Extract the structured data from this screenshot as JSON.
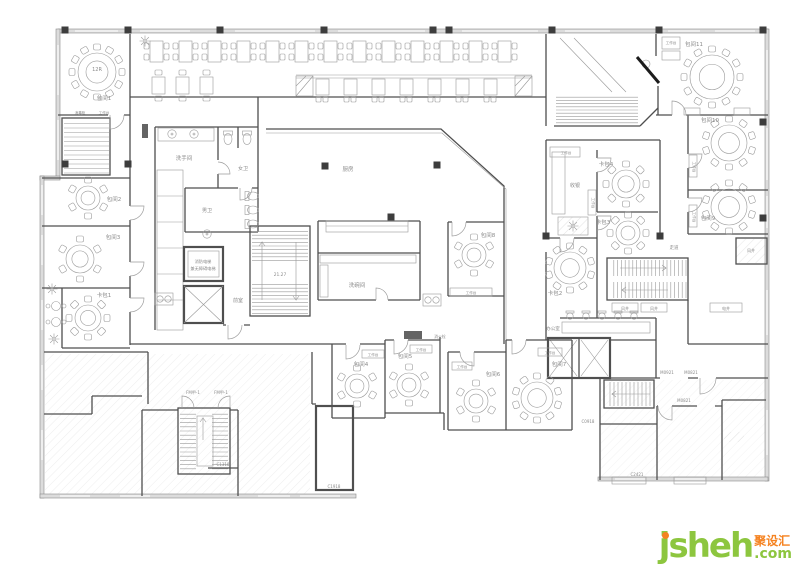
{
  "watermark": {
    "brand": "jsheh",
    "tld": ".com",
    "cn": "聚设汇",
    "brand_color": "#8dc63f",
    "accent_color": "#f58220"
  },
  "plan": {
    "labels": [
      {
        "t": "12R",
        "x": 97,
        "y": 71,
        "s": 5,
        "c": "#777777"
      },
      {
        "t": "包间1",
        "x": 104,
        "y": 100,
        "s": 5.5
      },
      {
        "t": "消毒柜",
        "x": 80,
        "y": 114,
        "s": 3.6
      },
      {
        "t": "工作台",
        "x": 104,
        "y": 114,
        "s": 3.6
      },
      {
        "t": "包间2",
        "x": 114,
        "y": 201,
        "s": 5.5
      },
      {
        "t": "包间3",
        "x": 113,
        "y": 239,
        "s": 5.5
      },
      {
        "t": "卡包1",
        "x": 104,
        "y": 297,
        "s": 5.5
      },
      {
        "t": "洗手间",
        "x": 184,
        "y": 160,
        "s": 5.5
      },
      {
        "t": "女卫",
        "x": 243,
        "y": 170,
        "s": 5
      },
      {
        "t": "男卫",
        "x": 207,
        "y": 212,
        "s": 5
      },
      {
        "t": "消防电梯",
        "x": 203,
        "y": 263,
        "s": 4.2,
        "c": "#b03a2e"
      },
      {
        "t": "兼无障碍电梯",
        "x": 203,
        "y": 270,
        "s": 4.2,
        "c": "#b03a2e"
      },
      {
        "t": "前室",
        "x": 238,
        "y": 302,
        "s": 5
      },
      {
        "t": "21.27",
        "x": 280,
        "y": 276,
        "s": 4.4
      },
      {
        "t": "厨房",
        "x": 348,
        "y": 171,
        "s": 5.5
      },
      {
        "t": "洗碗间",
        "x": 357,
        "y": 287,
        "s": 5.5
      },
      {
        "t": "包间8",
        "x": 488,
        "y": 237,
        "s": 5.5
      },
      {
        "t": "工作台",
        "x": 471,
        "y": 294,
        "s": 3.6
      },
      {
        "t": "工作台",
        "x": 566,
        "y": 154,
        "s": 3.6
      },
      {
        "t": "收银",
        "x": 575,
        "y": 187,
        "s": 5
      },
      {
        "t": "卡包4",
        "x": 606,
        "y": 166,
        "s": 5.5
      },
      {
        "t": "工作台",
        "x": 592,
        "y": 203,
        "s": 3.6,
        "rot": 90
      },
      {
        "t": "卡包3",
        "x": 603,
        "y": 224,
        "s": 5.5
      },
      {
        "t": "卡包2",
        "x": 555,
        "y": 295,
        "s": 5.5
      },
      {
        "t": "办公室",
        "x": 553,
        "y": 330,
        "s": 4.6
      },
      {
        "t": "风井",
        "x": 625,
        "y": 310,
        "s": 4
      },
      {
        "t": "风井",
        "x": 654,
        "y": 310,
        "s": 4
      },
      {
        "t": "电井",
        "x": 726,
        "y": 310,
        "s": 4
      },
      {
        "t": "包间11",
        "x": 694,
        "y": 46,
        "s": 5.5
      },
      {
        "t": "工作台",
        "x": 671,
        "y": 44,
        "s": 3.6
      },
      {
        "t": "包间10",
        "x": 710,
        "y": 122,
        "s": 5.5
      },
      {
        "t": "工作台",
        "x": 693,
        "y": 167,
        "s": 3.6,
        "rot": 90
      },
      {
        "t": "包间9",
        "x": 708,
        "y": 220,
        "s": 5.5
      },
      {
        "t": "工作台",
        "x": 693,
        "y": 217,
        "s": 3.6,
        "rot": 90
      },
      {
        "t": "走道",
        "x": 674,
        "y": 249,
        "s": 4.4
      },
      {
        "t": "风井",
        "x": 751,
        "y": 252,
        "s": 4
      },
      {
        "t": "消火栓",
        "x": 440,
        "y": 338,
        "s": 3.8
      },
      {
        "t": "包间4",
        "x": 361,
        "y": 366,
        "s": 5.5
      },
      {
        "t": "工作台",
        "x": 373,
        "y": 356,
        "s": 3.6
      },
      {
        "t": "包间5",
        "x": 405,
        "y": 358,
        "s": 5.5
      },
      {
        "t": "工作台",
        "x": 421,
        "y": 351,
        "s": 3.6
      },
      {
        "t": "包间6",
        "x": 493,
        "y": 376,
        "s": 5.5
      },
      {
        "t": "工作台",
        "x": 462,
        "y": 368,
        "s": 3.6
      },
      {
        "t": "包间7",
        "x": 559,
        "y": 366,
        "s": 5.5
      },
      {
        "t": "工作台",
        "x": 550,
        "y": 354,
        "s": 3.6
      },
      {
        "t": "FM甲-1",
        "x": 193,
        "y": 394,
        "s": 4
      },
      {
        "t": "FM甲-1",
        "x": 221,
        "y": 394,
        "s": 4
      },
      {
        "t": "C1318",
        "x": 223,
        "y": 466,
        "s": 4
      },
      {
        "t": "C1918",
        "x": 334,
        "y": 488,
        "s": 4
      },
      {
        "t": "C0918",
        "x": 588,
        "y": 423,
        "s": 4
      },
      {
        "t": "C2421",
        "x": 637,
        "y": 476,
        "s": 4
      },
      {
        "t": "M0921",
        "x": 667,
        "y": 374,
        "s": 4
      },
      {
        "t": "M0821",
        "x": 691,
        "y": 374,
        "s": 4
      },
      {
        "t": "M0821",
        "x": 684,
        "y": 402,
        "s": 4
      }
    ],
    "round_tables": [
      {
        "x": 97,
        "y": 72,
        "r": 19,
        "seats": 12
      },
      {
        "x": 88,
        "y": 198,
        "r": 12,
        "seats": 6
      },
      {
        "x": 80,
        "y": 259,
        "r": 14,
        "seats": 6
      },
      {
        "x": 88,
        "y": 318,
        "r": 13,
        "seats": 8
      },
      {
        "x": 474,
        "y": 255,
        "r": 12,
        "seats": 6
      },
      {
        "x": 626,
        "y": 184,
        "r": 14,
        "seats": 8
      },
      {
        "x": 628,
        "y": 233,
        "r": 12,
        "seats": 8
      },
      {
        "x": 570,
        "y": 268,
        "r": 16,
        "seats": 10
      },
      {
        "x": 712,
        "y": 77,
        "r": 22,
        "seats": 12
      },
      {
        "x": 729,
        "y": 143,
        "r": 18,
        "seats": 10
      },
      {
        "x": 729,
        "y": 207,
        "r": 18,
        "seats": 10
      },
      {
        "x": 357,
        "y": 386,
        "r": 12,
        "seats": 6
      },
      {
        "x": 409,
        "y": 385,
        "r": 12,
        "seats": 6
      },
      {
        "x": 476,
        "y": 401,
        "r": 12,
        "seats": 6
      },
      {
        "x": 537,
        "y": 398,
        "r": 16,
        "seats": 10
      }
    ],
    "booth_row_top": {
      "y": 41,
      "w": 13,
      "h": 21,
      "start_x": 150,
      "gap": 29,
      "count": 13
    },
    "booth_row_mid": {
      "y": 79,
      "w": 13,
      "h": 16,
      "start_x": 316,
      "gap": 28,
      "count": 7,
      "bench_x1": 296,
      "bench_x2": 532,
      "bench_y": 75
    },
    "booth_row_left": {
      "y": 77,
      "w": 13,
      "h": 17,
      "start_x": 152,
      "gap": 24,
      "count": 3
    },
    "columns": [
      [
        65,
        30
      ],
      [
        128,
        30
      ],
      [
        220,
        30
      ],
      [
        324,
        30
      ],
      [
        433,
        30
      ],
      [
        449,
        30
      ],
      [
        552,
        30
      ],
      [
        659,
        30
      ],
      [
        763,
        30
      ],
      [
        65,
        164
      ],
      [
        128,
        164
      ],
      [
        325,
        166
      ],
      [
        437,
        165
      ],
      [
        391,
        217
      ],
      [
        763,
        122
      ],
      [
        763,
        218
      ],
      [
        546,
        236
      ],
      [
        660,
        236
      ]
    ],
    "plants": [
      [
        145,
        41
      ],
      [
        52,
        289
      ],
      [
        54,
        339
      ],
      [
        573,
        226
      ]
    ],
    "lounge_tables": [
      [
        56,
        306
      ],
      [
        56,
        322
      ]
    ],
    "office_chairs_x": [
      570,
      586,
      602,
      618,
      634
    ],
    "office_chairs_y": 316,
    "toilets": [
      {
        "x": 228,
        "y": 137,
        "rot": 0
      },
      {
        "x": 247,
        "y": 137,
        "rot": 0
      },
      {
        "x": 251,
        "y": 196,
        "rot": -90
      },
      {
        "x": 251,
        "y": 210,
        "rot": -90
      },
      {
        "x": 251,
        "y": 224,
        "rot": -90
      }
    ],
    "basins": [
      [
        172,
        134
      ],
      [
        194,
        134
      ],
      [
        207,
        234
      ]
    ],
    "floor_symbols": [
      [
        160,
        299
      ],
      [
        428,
        300
      ]
    ],
    "stairs": [
      {
        "x": 64,
        "y": 119,
        "w": 45,
        "h": 55,
        "dir": "v",
        "step": 4.5
      },
      {
        "x": 252,
        "y": 228,
        "w": 56,
        "h": 36,
        "dir": "v",
        "step": 3.6
      },
      {
        "x": 252,
        "y": 281,
        "w": 56,
        "h": 33,
        "dir": "v",
        "step": 3.6
      },
      {
        "x": 610,
        "y": 260,
        "w": 76,
        "h": 16,
        "dir": "h",
        "step": 3.8
      },
      {
        "x": 610,
        "y": 282,
        "w": 76,
        "h": 16,
        "dir": "h",
        "step": 3.8
      },
      {
        "x": 180,
        "y": 410,
        "w": 16,
        "h": 62,
        "dir": "v",
        "step": 4.2
      },
      {
        "x": 212,
        "y": 410,
        "w": 16,
        "h": 62,
        "dir": "v",
        "step": 4.2
      },
      {
        "x": 606,
        "y": 382,
        "w": 46,
        "h": 24,
        "dir": "h",
        "step": 4
      },
      {
        "x": 556,
        "y": 94,
        "w": 82,
        "h": 29,
        "dir": "v",
        "step": 3.2
      }
    ]
  }
}
